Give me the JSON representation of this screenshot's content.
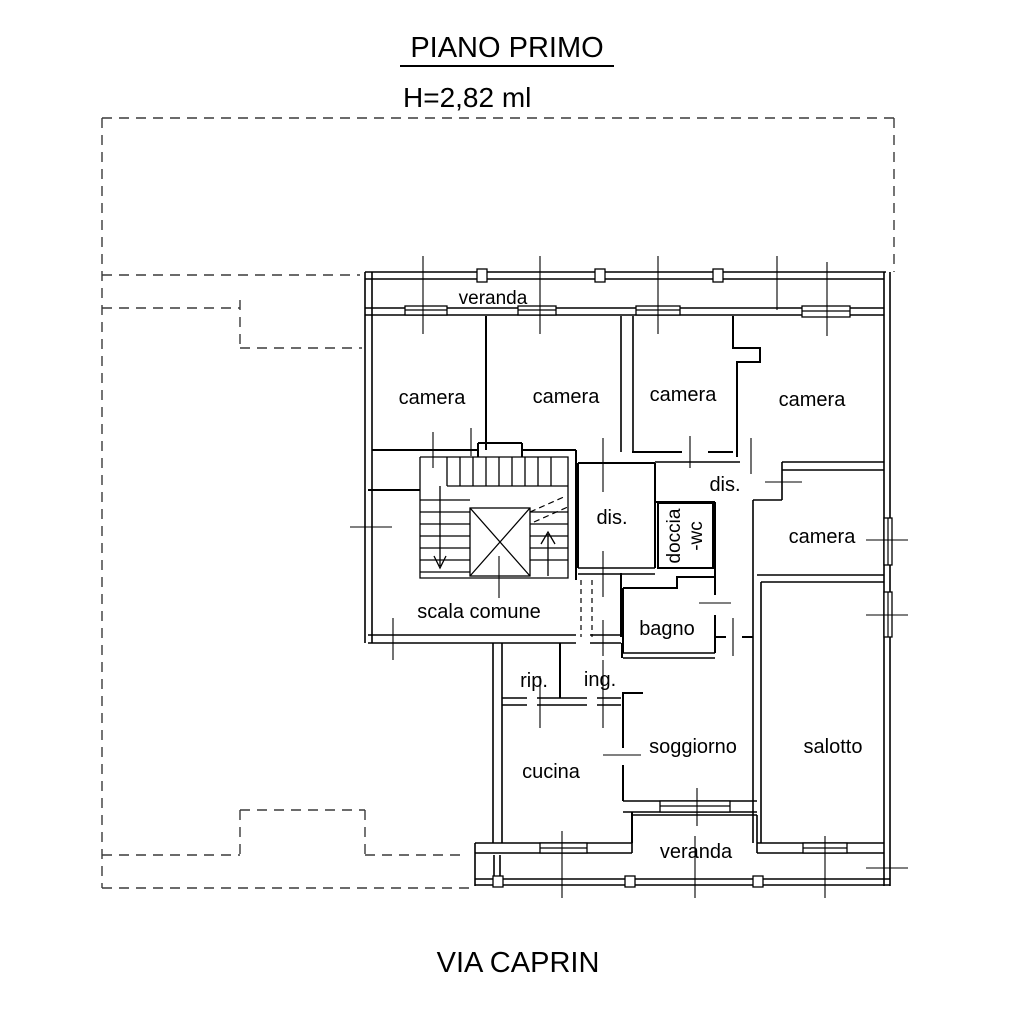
{
  "header": {
    "title": "PIANO PRIMO",
    "subtitle": "H=2,82 ml"
  },
  "footer": {
    "street": "VIA CAPRIN"
  },
  "rooms": {
    "veranda_top": "veranda",
    "camera1": "camera",
    "camera2": "camera",
    "camera3": "camera",
    "camera4": "camera",
    "dis1": "dis.",
    "dis2": "dis.",
    "doccia_wc_line1": "doccia",
    "doccia_wc_line2": "-wc",
    "bagno": "bagno",
    "camera_right": "camera",
    "scala_comune": "scala comune",
    "rip": "rip.",
    "ing": "ing.",
    "cucina": "cucina",
    "soggiorno": "soggiorno",
    "salotto": "salotto",
    "veranda_bottom": "veranda"
  },
  "colors": {
    "walls": "#000000",
    "boundary": "#3a3a3a",
    "background": "#ffffff"
  }
}
